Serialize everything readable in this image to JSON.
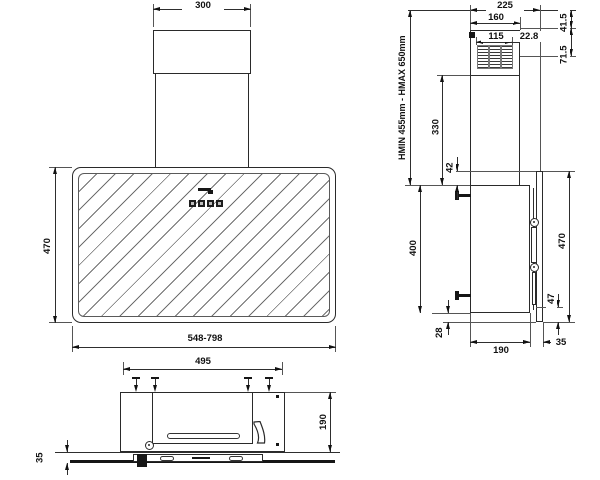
{
  "drawing": {
    "front": {
      "chimney_width": "300",
      "panel_height": "470",
      "width_range": "548-798"
    },
    "side": {
      "total_depth": "225",
      "chimney_depth": "160",
      "outlet_width": "115",
      "outlet_offset": "22.8",
      "outlet_top_offset": "41.5",
      "outlet_height": "71.5",
      "mount_height_range": "HMIN 455mm - HMAX 650mm",
      "chimney_lower_height": "330",
      "panel_top_overhang": "42",
      "body_height": "400",
      "panel_height": "470",
      "bottom_clearance": "47",
      "panel_bottom_overhang": "28",
      "body_depth": "190",
      "panel_thickness": "35"
    },
    "bottom": {
      "body_width": "495",
      "body_depth": "190",
      "panel_thickness": "35"
    },
    "icons": {
      "brand_logo": "brand-logo",
      "controls": "control-buttons"
    }
  }
}
